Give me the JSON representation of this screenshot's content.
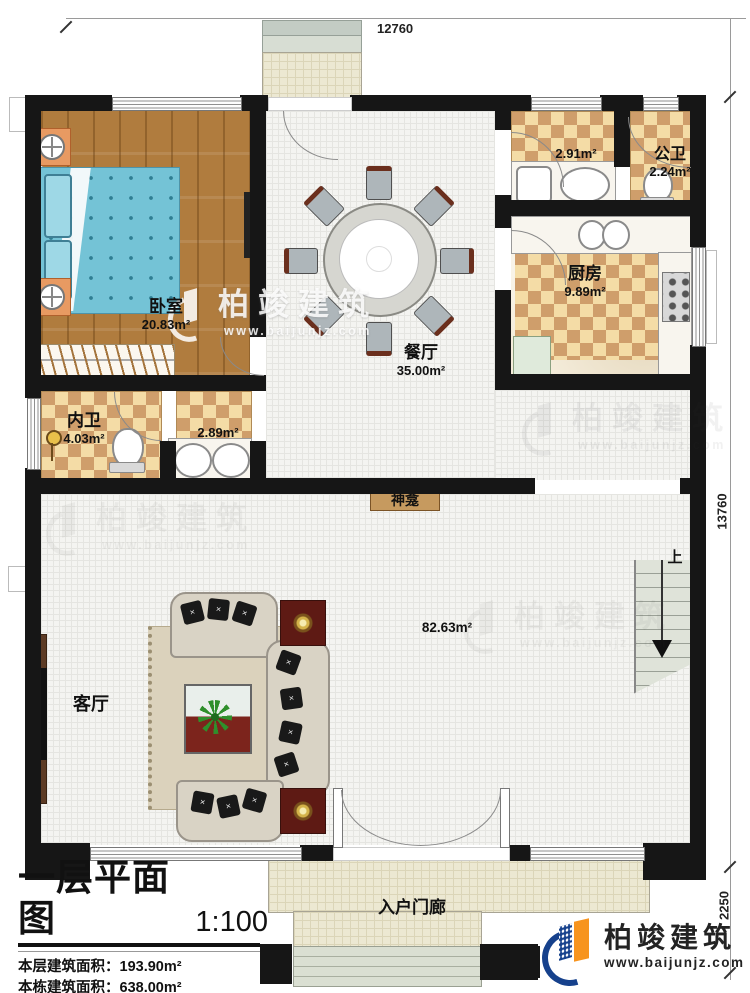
{
  "dimensions": {
    "top": "12760",
    "right": "13760",
    "bottom_right": "2250"
  },
  "rooms": {
    "bedroom": {
      "name": "卧室",
      "area": "20.83m²"
    },
    "dining": {
      "name": "餐厅",
      "area": "35.00m²"
    },
    "laundry": {
      "area": "2.91m²"
    },
    "public_bath": {
      "name": "公卫",
      "area": "2.24m²"
    },
    "kitchen": {
      "name": "厨房",
      "area": "9.89m²"
    },
    "private_bath": {
      "name": "内卫",
      "area": "4.03m²"
    },
    "vanity": {
      "area": "2.89m²"
    },
    "shrine": {
      "name": "神龛"
    },
    "living": {
      "name": "客厅",
      "area": "82.63m²"
    },
    "stairs": {
      "label": "上"
    },
    "porch": {
      "name": "入户门廊"
    }
  },
  "title_block": {
    "title": "一层平面图",
    "scale": "1:100",
    "rows": [
      {
        "label": "本层建筑面积：",
        "value": "193.90m²"
      },
      {
        "label": "本栋建筑面积：",
        "value": "638.00m²"
      },
      {
        "label": "占地面积：",
        "value": "193.9m²",
        "label2": "层高：",
        "value2": "4.0m"
      }
    ]
  },
  "branding": {
    "company": "柏竣建筑",
    "website": "www.baijunjz.com",
    "brand_blue": "#16418c",
    "brand_orange": "#f7941e",
    "wall_color": "#161616"
  },
  "watermark": {
    "company": "柏竣建筑",
    "website": "www.baijunjz.com"
  }
}
